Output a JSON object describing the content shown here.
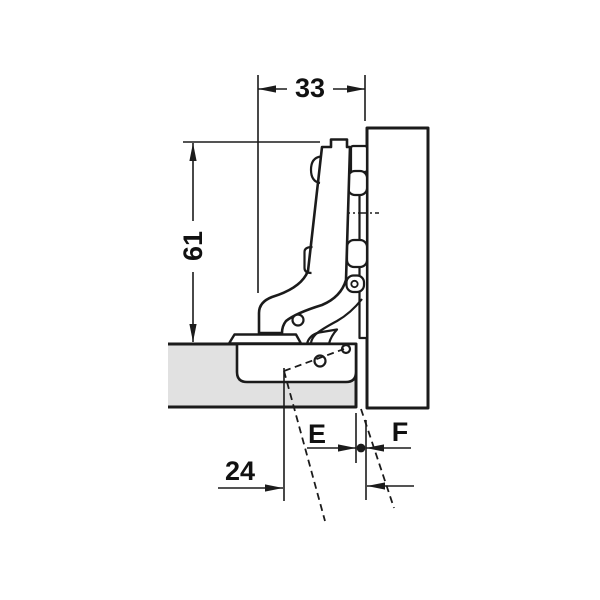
{
  "diagram": {
    "labels": {
      "dim_width": "33",
      "dim_height": "61",
      "dim_drilling": "24",
      "dim_e": "E",
      "dim_f": "F"
    },
    "colors": {
      "panel_fill": "#e1e1e1",
      "line": "#1b1b1b",
      "background": "#ffffff"
    }
  }
}
